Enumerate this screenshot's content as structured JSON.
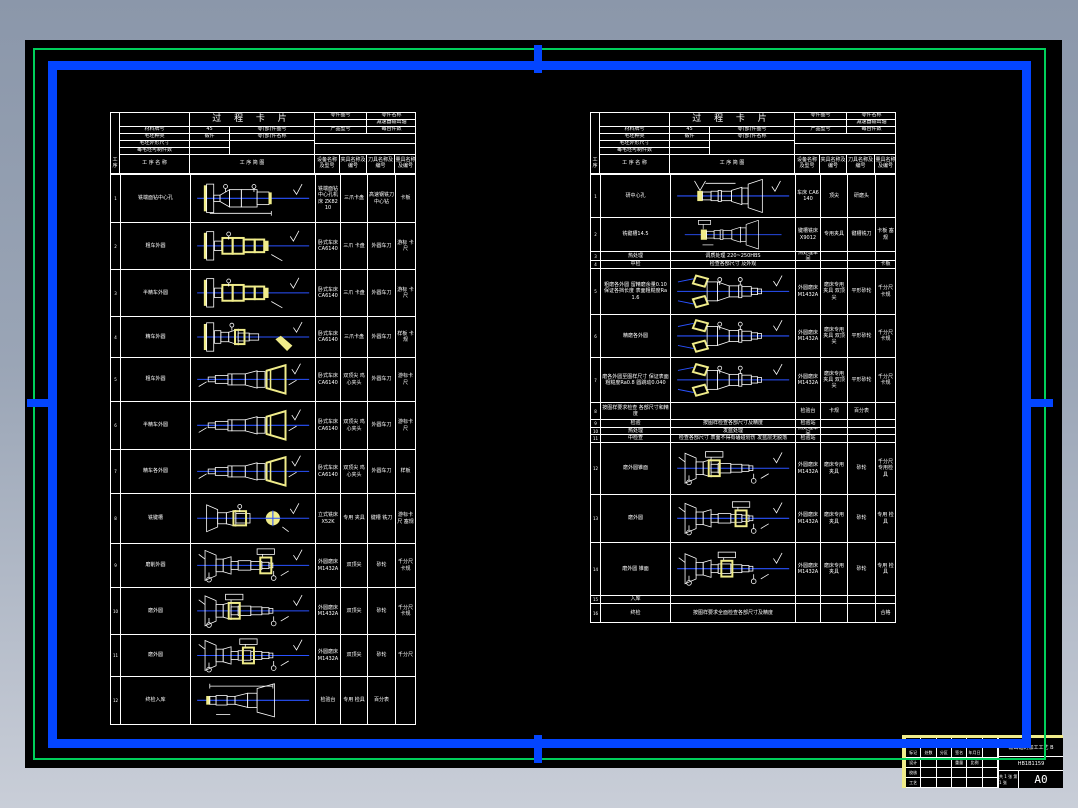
{
  "colors": {
    "background_top": "#8b97aa",
    "background_bottom": "#c9ced8",
    "canvas": "#000000",
    "sheet_border_green": "#00cf5a",
    "sheet_border_blue": "#0345ff",
    "line_white": "#ffffff",
    "highlight_yellow": "#f0ec8a",
    "centerline_blue": "#2a52ff"
  },
  "header": {
    "title": "过 程 卡 片",
    "left_labels": [
      "材料牌号",
      "毛坯种类",
      "毛坯外形尺寸",
      "每毛坯可制件数"
    ],
    "left_values": [
      "45",
      "锻件",
      "",
      ""
    ],
    "top_right_labels": [
      "零件图号",
      "零件名称"
    ],
    "part_name": "减速器输出轴",
    "mid_right_labels": [
      "产品型号",
      "每台件数"
    ],
    "col_headers": [
      "工序",
      "工 序 名 称",
      "工  序  简  图",
      "设备名称及型号",
      "夹具名称及编号",
      "刀具名称及编号",
      "量具名称及编号"
    ]
  },
  "left_table": {
    "rows": [
      {
        "no": "1",
        "name": "铣端面钻中心孔",
        "sk": "faceDrill",
        "h": 48,
        "cells": [
          "铣端面钻中心孔机床 ZK8210",
          "三爪卡盘",
          "高速钢铣刀 中心钻",
          "卡板"
        ]
      },
      {
        "no": "2",
        "name": "粗车外圆",
        "sk": "turnY",
        "h": 47,
        "cells": [
          "卧式车床 CA6140",
          "三爪 卡盘",
          "外圆车刀",
          "游标 卡尺"
        ]
      },
      {
        "no": "3",
        "name": "半精车外圆",
        "sk": "turnY",
        "h": 47,
        "cells": [
          "卧式车床 CA6140",
          "三爪 卡盘",
          "外圆车刀",
          "游标 卡尺"
        ]
      },
      {
        "no": "4",
        "name": "精车外圆",
        "sk": "turnTool",
        "h": 41,
        "cells": [
          "卧式车床CA6140",
          "三爪卡盘",
          "外圆车刀",
          "样板 卡规"
        ]
      },
      {
        "no": "5",
        "name": "粗车外圆",
        "sk": "tailR",
        "h": 44,
        "cells": [
          "卧式车床 CA6140",
          "双顶尖 鸡心夹头",
          "外圆车刀",
          "游标卡尺"
        ]
      },
      {
        "no": "6",
        "name": "半精车外圆",
        "sk": "tailR",
        "h": 48,
        "cells": [
          "卧式车床 CA6140",
          "双顶尖 鸡心夹头",
          "外圆车刀",
          "游标卡尺"
        ]
      },
      {
        "no": "7",
        "name": "精车各外圆",
        "sk": "tailR",
        "h": 44,
        "cells": [
          "卧式车床 CA6140",
          "双顶尖 鸡心夹头",
          "外圆车刀",
          "样板"
        ]
      },
      {
        "no": "8",
        "name": "铣键槽",
        "sk": "millkey",
        "h": 50,
        "cells": [
          "立式铣床 X52K",
          "专用 夹具",
          "键槽 铣刀",
          "游标卡尺 塞规"
        ]
      },
      {
        "no": "9",
        "name": "磨削外圆",
        "sk": "grind",
        "skx": 84,
        "h": 44,
        "cells": [
          "外圆磨床 M1432A",
          "双顶尖",
          "砂轮",
          "千分尺 卡规"
        ]
      },
      {
        "no": "10",
        "name": "磨外圆",
        "sk": "grind",
        "skx": 44,
        "h": 47,
        "cells": [
          "外圆磨床 M1432A",
          "双顶尖",
          "砂轮",
          "千分尺 卡规"
        ]
      },
      {
        "no": "11",
        "name": "磨外圆",
        "sk": "grind",
        "skx": 62,
        "h": 42,
        "cells": [
          "外圆磨床 M1432A",
          "双顶尖",
          "砂轮",
          "千分尺"
        ]
      },
      {
        "no": "12",
        "name": "终检入库",
        "sk": "finalPart",
        "h": 48,
        "cells": [
          "检验台",
          "专用 检具",
          "百分表",
          ""
        ]
      }
    ]
  },
  "right_table": {
    "rows": [
      {
        "no": "1",
        "name": "研中心孔",
        "sk": "csinkR",
        "h": 43,
        "cells": [
          "车床 CA6140",
          "顶尖",
          "研磨头",
          ""
        ]
      },
      {
        "no": "2",
        "name": "铣键槽14.5",
        "sk": "csinkR2",
        "h": 34,
        "cells": [
          "键槽铣床 X9012",
          "专用夹具",
          "键槽铣刀",
          "卡板 塞规"
        ]
      },
      {
        "no": "3",
        "name": "热处理",
        "span": "调质处理 220~250HBS",
        "h": 9,
        "cells": [
          "热处理车间",
          "",
          "",
          ""
        ]
      },
      {
        "no": "4",
        "name": "中检",
        "span": "检查各部尺寸 及外观",
        "h": 8,
        "cells": [
          "",
          "",
          "",
          "卡板"
        ]
      },
      {
        "no": "5",
        "name": "粗磨各外圆 留精磨余量0.10 保证各挡长度 表面粗糙度Ra1.6",
        "sk": "jaws",
        "h": 46,
        "cells": [
          "外圆磨床 M1432A",
          "磨床专用夹具 双顶尖",
          "平形砂轮",
          "千分尺 卡规"
        ]
      },
      {
        "no": "6",
        "name": "精磨各外圆",
        "sk": "jaws",
        "h": 43,
        "cells": [
          "外圆磨床 M1432A",
          "磨床专用夹具 双顶尖",
          "平形砂轮",
          "千分尺 卡规"
        ]
      },
      {
        "no": "7",
        "name": "磨各外圆至图样尺寸 保证表面粗糙度Ra0.8 圆跳动0.040",
        "sk": "jaws",
        "h": 45,
        "cells": [
          "外圆磨床 M1432A",
          "磨床专用夹具 双顶尖",
          "平形砂轮",
          "千分尺 卡规"
        ]
      },
      {
        "no": "8",
        "name": "按图样要求检查 各部尺寸和精度",
        "h": 17,
        "cells": [
          "检验台",
          "卡规",
          "百分表",
          ""
        ]
      },
      {
        "no": "9",
        "name": "检验",
        "span": "按图样检查各部尺寸及精度",
        "h": 8,
        "cells": [
          "检验站",
          "",
          "",
          ""
        ]
      },
      {
        "no": "10",
        "name": "热处理",
        "span": "发蓝处理",
        "h": 7,
        "cells": [
          "热处理车间",
          "",
          "",
          ""
        ]
      },
      {
        "no": "11",
        "name": "中检查",
        "span": "检查各部尺寸 表面不得有磕碰划伤 发蓝层无脱落",
        "h": 8,
        "cells": [
          "检验站",
          "",
          "",
          ""
        ]
      },
      {
        "no": "12",
        "name": "磨外圆锥面",
        "sk": "grind",
        "skx": 44,
        "h": 52,
        "cells": [
          "外圆磨床 M1432A",
          "磨床专用夹具",
          "砂轮",
          "千分尺 专用检具"
        ]
      },
      {
        "no": "13",
        "name": "磨外圆",
        "sk": "grind",
        "skx": 78,
        "h": 48,
        "cells": [
          "外圆磨床 M1432A",
          "磨床专用夹具",
          "砂轮",
          "专用 检具"
        ]
      },
      {
        "no": "14",
        "name": "磨外圆 锥面",
        "sk": "grind",
        "skx": 60,
        "h": 53,
        "cells": [
          "外圆磨床 M1432A",
          "磨床专用夹具",
          "砂轮",
          "专用 检具"
        ]
      },
      {
        "no": "15",
        "name": "入库",
        "span": "",
        "h": 8,
        "cells": [
          "",
          "",
          "",
          ""
        ]
      },
      {
        "no": "16",
        "name": "终检",
        "span": "按图样要求全面检查各部尺寸及精度",
        "h": 19,
        "cells": [
          "",
          "",
          "",
          "合格"
        ]
      }
    ]
  },
  "title_block": {
    "title": "输出轴的加工工艺 B",
    "doc_no": "HB1B1159",
    "size": "A0",
    "pages": "共 1 张 第 1 张",
    "sign_labels": [
      "设计",
      "校核",
      "审核",
      "工艺",
      "批准"
    ],
    "mark_labels": [
      "标记",
      "处数",
      "分区",
      "签名",
      "年月日"
    ],
    "stage_labels": [
      "阶段标记",
      "重量",
      "比例"
    ]
  }
}
